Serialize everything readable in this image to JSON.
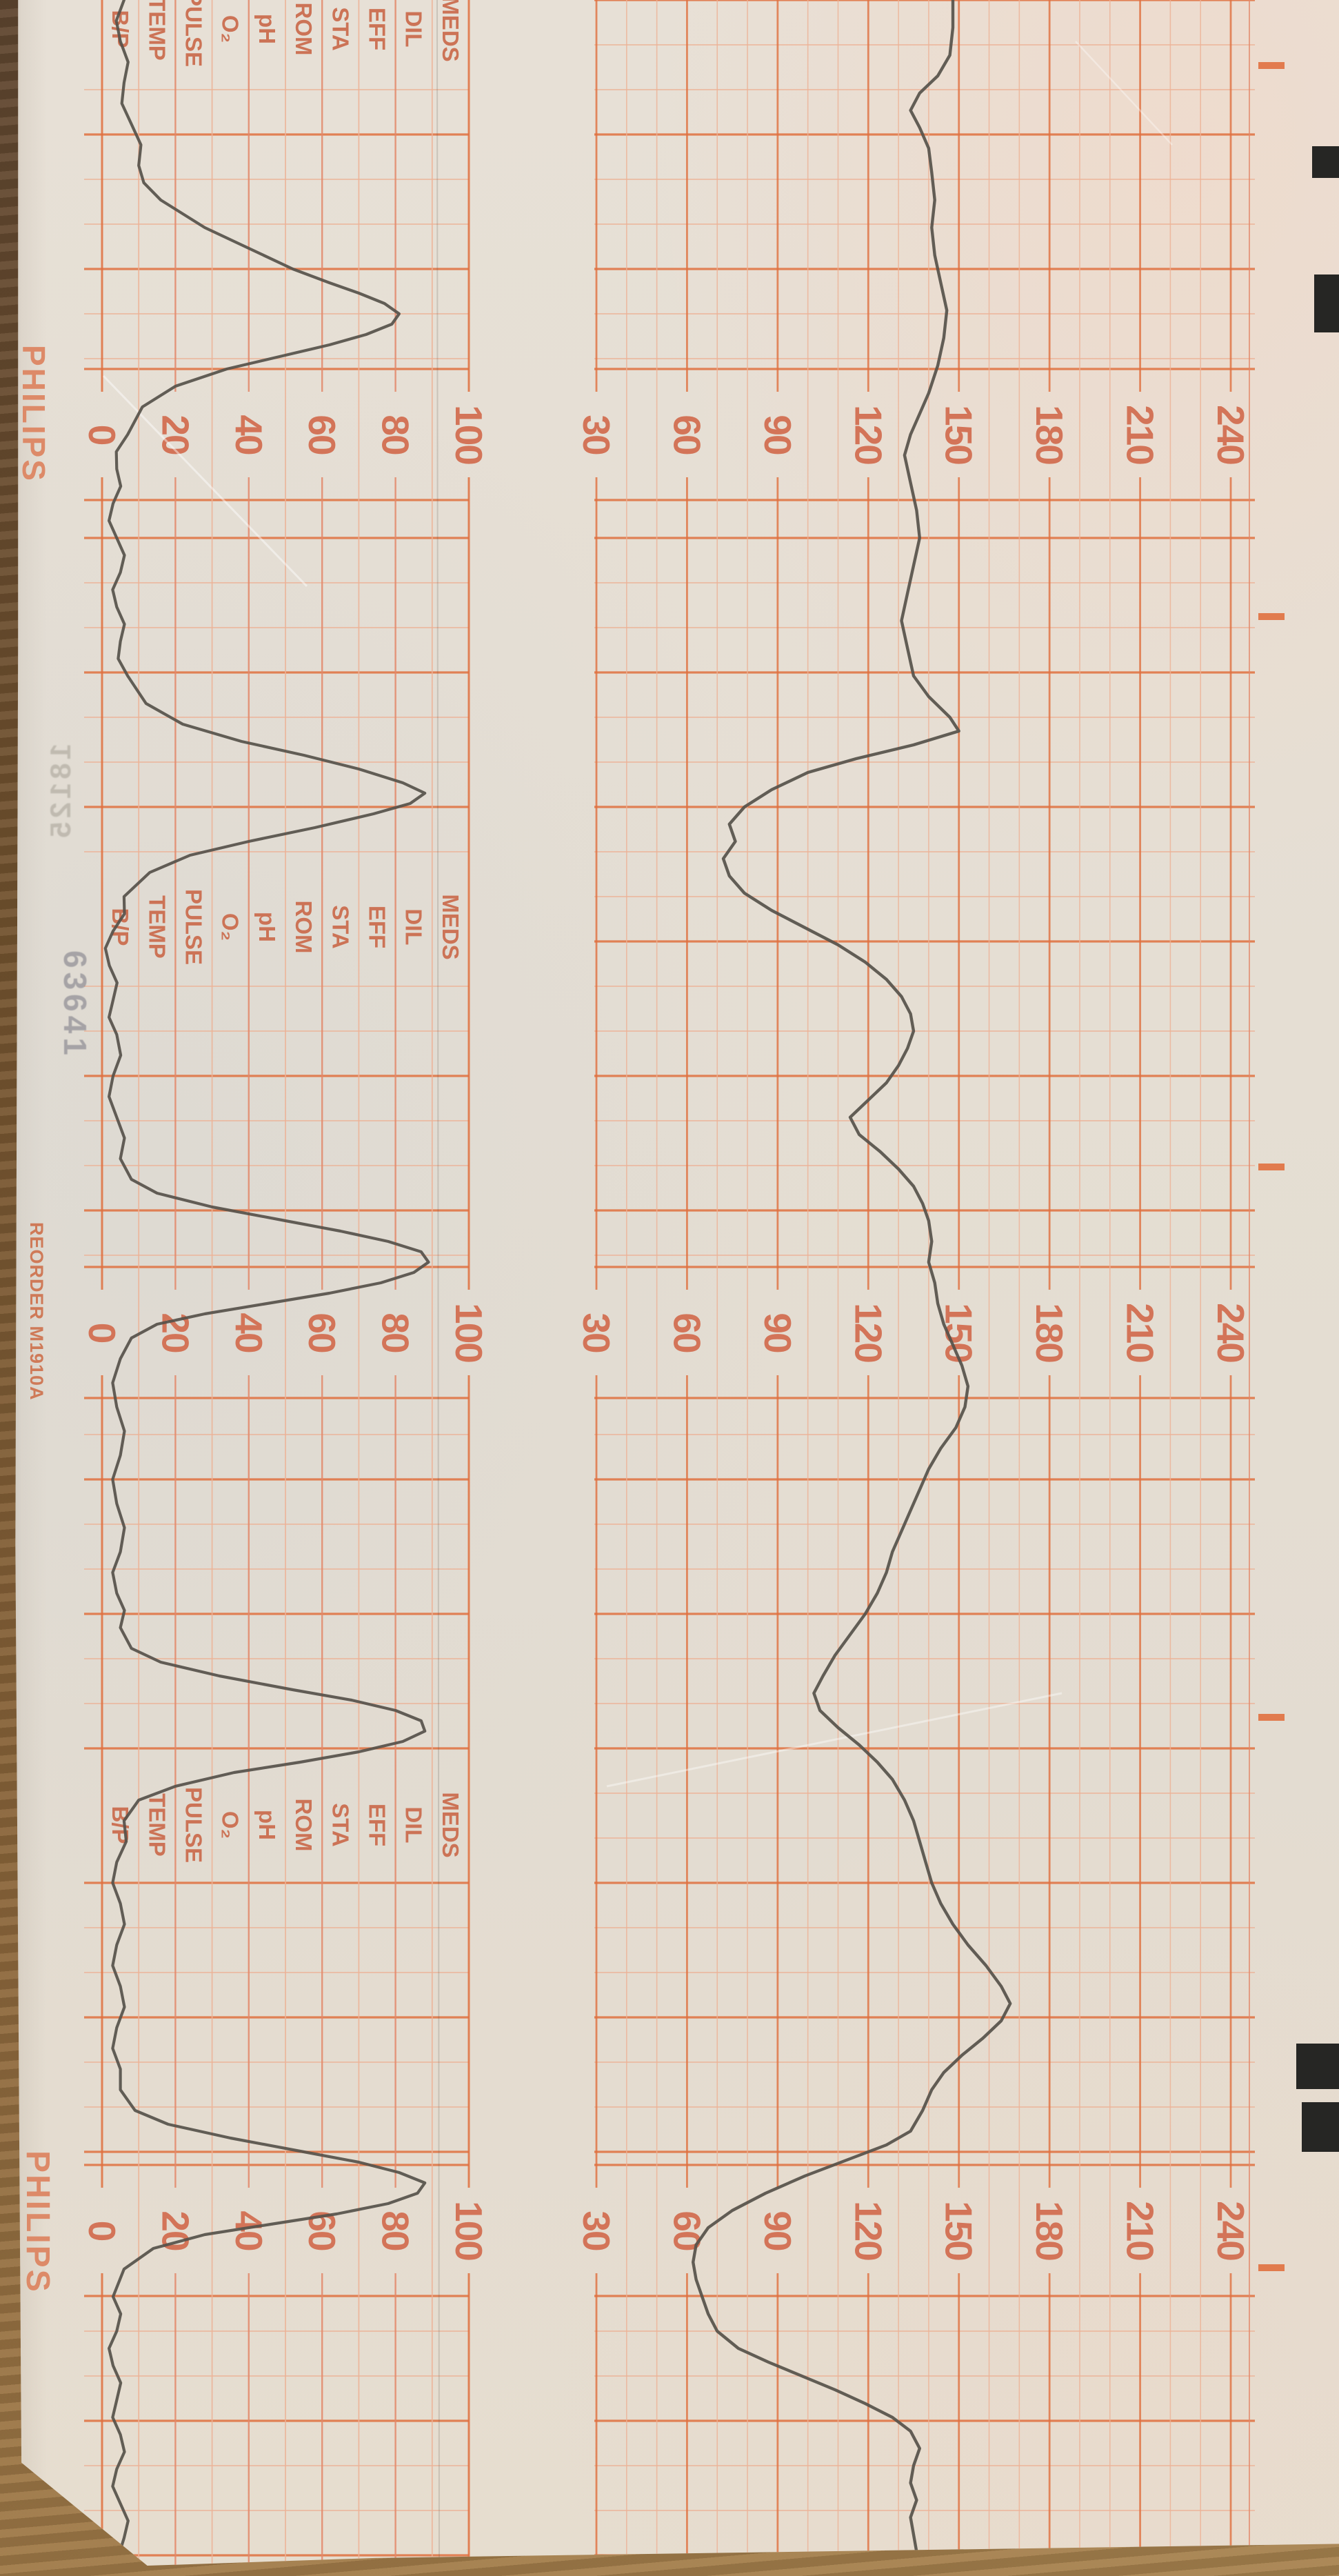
{
  "device": {
    "brand": "PHILIPS",
    "reorder_label": "REORDER M1910A",
    "stamp_number": "63641",
    "margin_ghost_number": "18125"
  },
  "scales": {
    "fhr": {
      "unit": "bpm",
      "min": 30,
      "max": 240,
      "major_step": 30,
      "minor_step": 10,
      "labels": [
        "30",
        "60",
        "90",
        "120",
        "150",
        "180",
        "210",
        "240"
      ]
    },
    "uterine": {
      "unit": "rel",
      "min": 0,
      "max": 100,
      "major_step": 20,
      "minor_step": 10,
      "labels": [
        "0",
        "20",
        "40",
        "60",
        "80",
        "100"
      ]
    }
  },
  "annotation_labels": [
    "MEDS",
    "DIL",
    "EFF",
    "STA",
    "ROM",
    "pH",
    "O₂",
    "PULSE",
    "TEMP",
    "B/P"
  ],
  "colors": {
    "grid_light": "#edb296",
    "grid_medium": "#e3886a",
    "grid_bold": "#e0703f",
    "scale_number": "#d26c4e",
    "annotation_label": "#cb6e50",
    "brand": "#dd8a68",
    "trace_ink": "#56514a",
    "black_mark": "#262624",
    "paper": "#e5ded3",
    "wood": "#7a5a35"
  },
  "chart_data": [
    {
      "type": "line",
      "name": "fetal_heart_rate",
      "legend": "FHR trace (pen)",
      "unit": "bpm",
      "axis_range": [
        30,
        240
      ],
      "x_axis": "image_y_px (time runs down the strip)",
      "points": [
        [
          0,
          148
        ],
        [
          40,
          148
        ],
        [
          80,
          147
        ],
        [
          110,
          143
        ],
        [
          135,
          137
        ],
        [
          160,
          134
        ],
        [
          185,
          137
        ],
        [
          215,
          140
        ],
        [
          250,
          141
        ],
        [
          290,
          142
        ],
        [
          330,
          141
        ],
        [
          370,
          142
        ],
        [
          410,
          144
        ],
        [
          450,
          146
        ],
        [
          490,
          145
        ],
        [
          530,
          143
        ],
        [
          570,
          140
        ],
        [
          600,
          137
        ],
        [
          630,
          134
        ],
        [
          660,
          132
        ],
        [
          700,
          134
        ],
        [
          740,
          136
        ],
        [
          780,
          137
        ],
        [
          820,
          135
        ],
        [
          860,
          133
        ],
        [
          900,
          131
        ],
        [
          940,
          133
        ],
        [
          980,
          135
        ],
        [
          1010,
          140
        ],
        [
          1040,
          147
        ],
        [
          1060,
          150
        ],
        [
          1080,
          135
        ],
        [
          1100,
          116
        ],
        [
          1120,
          100
        ],
        [
          1145,
          88
        ],
        [
          1170,
          79
        ],
        [
          1195,
          74
        ],
        [
          1220,
          76
        ],
        [
          1245,
          72
        ],
        [
          1270,
          74
        ],
        [
          1295,
          79
        ],
        [
          1320,
          88
        ],
        [
          1345,
          99
        ],
        [
          1370,
          110
        ],
        [
          1395,
          119
        ],
        [
          1420,
          126
        ],
        [
          1445,
          131
        ],
        [
          1470,
          134
        ],
        [
          1495,
          135
        ],
        [
          1520,
          133
        ],
        [
          1545,
          130
        ],
        [
          1570,
          126
        ],
        [
          1595,
          120
        ],
        [
          1620,
          114
        ],
        [
          1645,
          117
        ],
        [
          1670,
          124
        ],
        [
          1695,
          130
        ],
        [
          1720,
          135
        ],
        [
          1745,
          138
        ],
        [
          1770,
          140
        ],
        [
          1800,
          141
        ],
        [
          1830,
          140
        ],
        [
          1860,
          142
        ],
        [
          1890,
          143
        ],
        [
          1920,
          145
        ],
        [
          1950,
          148
        ],
        [
          1980,
          151
        ],
        [
          2010,
          153
        ],
        [
          2040,
          152
        ],
        [
          2070,
          149
        ],
        [
          2100,
          144
        ],
        [
          2130,
          140
        ],
        [
          2160,
          137
        ],
        [
          2190,
          134
        ],
        [
          2220,
          131
        ],
        [
          2250,
          128
        ],
        [
          2280,
          126
        ],
        [
          2310,
          123
        ],
        [
          2340,
          119
        ],
        [
          2370,
          114
        ],
        [
          2400,
          109
        ],
        [
          2430,
          105
        ],
        [
          2455,
          102
        ],
        [
          2480,
          104
        ],
        [
          2505,
          110
        ],
        [
          2530,
          117
        ],
        [
          2555,
          123
        ],
        [
          2580,
          128
        ],
        [
          2610,
          132
        ],
        [
          2640,
          135
        ],
        [
          2670,
          137
        ],
        [
          2700,
          139
        ],
        [
          2730,
          141
        ],
        [
          2760,
          144
        ],
        [
          2790,
          148
        ],
        [
          2820,
          153
        ],
        [
          2850,
          159
        ],
        [
          2880,
          164
        ],
        [
          2905,
          167
        ],
        [
          2930,
          164
        ],
        [
          2955,
          158
        ],
        [
          2980,
          151
        ],
        [
          3005,
          145
        ],
        [
          3030,
          141
        ],
        [
          3060,
          138
        ],
        [
          3090,
          134
        ],
        [
          3110,
          126
        ],
        [
          3130,
          114
        ],
        [
          3155,
          99
        ],
        [
          3180,
          86
        ],
        [
          3205,
          75
        ],
        [
          3230,
          67
        ],
        [
          3255,
          63
        ],
        [
          3280,
          62
        ],
        [
          3305,
          63
        ],
        [
          3330,
          65
        ],
        [
          3355,
          67
        ],
        [
          3380,
          70
        ],
        [
          3405,
          77
        ],
        [
          3425,
          87
        ],
        [
          3445,
          98
        ],
        [
          3465,
          109
        ],
        [
          3485,
          119
        ],
        [
          3505,
          128
        ],
        [
          3525,
          134
        ],
        [
          3550,
          137
        ],
        [
          3575,
          135
        ],
        [
          3600,
          134
        ],
        [
          3625,
          136
        ],
        [
          3650,
          134
        ],
        [
          3675,
          135
        ],
        [
          3700,
          136
        ],
        [
          3735,
          135
        ]
      ]
    },
    {
      "type": "line",
      "name": "uterine_activity",
      "legend": "Toco trace (pen)",
      "unit": "rel",
      "axis_range": [
        0,
        100
      ],
      "x_axis": "image_y_px (time runs down the strip)",
      "points": [
        [
          0,
          6
        ],
        [
          60,
          5
        ],
        [
          120,
          6
        ],
        [
          180,
          8
        ],
        [
          240,
          10
        ],
        [
          290,
          16
        ],
        [
          330,
          28
        ],
        [
          360,
          40
        ],
        [
          390,
          52
        ],
        [
          410,
          62
        ],
        [
          425,
          70
        ],
        [
          440,
          77
        ],
        [
          455,
          81
        ],
        [
          470,
          79
        ],
        [
          485,
          72
        ],
        [
          500,
          62
        ],
        [
          515,
          50
        ],
        [
          535,
          34
        ],
        [
          560,
          20
        ],
        [
          590,
          11
        ],
        [
          630,
          7
        ],
        [
          680,
          4
        ],
        [
          730,
          3
        ],
        [
          780,
          4
        ],
        [
          830,
          5
        ],
        [
          880,
          4
        ],
        [
          930,
          5
        ],
        [
          980,
          7
        ],
        [
          1020,
          12
        ],
        [
          1050,
          22
        ],
        [
          1075,
          38
        ],
        [
          1095,
          55
        ],
        [
          1115,
          70
        ],
        [
          1135,
          82
        ],
        [
          1150,
          88
        ],
        [
          1165,
          84
        ],
        [
          1180,
          74
        ],
        [
          1200,
          58
        ],
        [
          1220,
          40
        ],
        [
          1240,
          24
        ],
        [
          1265,
          13
        ],
        [
          1300,
          6
        ],
        [
          1350,
          3
        ],
        [
          1400,
          2
        ],
        [
          1450,
          3
        ],
        [
          1500,
          4
        ],
        [
          1560,
          3
        ],
        [
          1620,
          4
        ],
        [
          1680,
          5
        ],
        [
          1710,
          8
        ],
        [
          1730,
          15
        ],
        [
          1750,
          30
        ],
        [
          1770,
          50
        ],
        [
          1785,
          65
        ],
        [
          1800,
          78
        ],
        [
          1815,
          87
        ],
        [
          1830,
          89
        ],
        [
          1845,
          85
        ],
        [
          1860,
          76
        ],
        [
          1875,
          62
        ],
        [
          1890,
          45
        ],
        [
          1905,
          28
        ],
        [
          1920,
          15
        ],
        [
          1940,
          8
        ],
        [
          1970,
          5
        ],
        [
          2040,
          4
        ],
        [
          2110,
          5
        ],
        [
          2180,
          4
        ],
        [
          2250,
          5
        ],
        [
          2310,
          4
        ],
        [
          2360,
          5
        ],
        [
          2390,
          8
        ],
        [
          2410,
          16
        ],
        [
          2430,
          32
        ],
        [
          2450,
          52
        ],
        [
          2465,
          68
        ],
        [
          2480,
          80
        ],
        [
          2495,
          87
        ],
        [
          2510,
          88
        ],
        [
          2525,
          82
        ],
        [
          2540,
          70
        ],
        [
          2555,
          54
        ],
        [
          2570,
          36
        ],
        [
          2590,
          20
        ],
        [
          2610,
          10
        ],
        [
          2640,
          6
        ],
        [
          2700,
          4
        ],
        [
          2760,
          5
        ],
        [
          2820,
          4
        ],
        [
          2880,
          5
        ],
        [
          2940,
          4
        ],
        [
          3000,
          5
        ],
        [
          3030,
          5
        ],
        [
          3060,
          9
        ],
        [
          3080,
          18
        ],
        [
          3100,
          35
        ],
        [
          3120,
          55
        ],
        [
          3135,
          70
        ],
        [
          3150,
          81
        ],
        [
          3165,
          88
        ],
        [
          3180,
          86
        ],
        [
          3195,
          78
        ],
        [
          3210,
          64
        ],
        [
          3225,
          46
        ],
        [
          3240,
          28
        ],
        [
          3260,
          14
        ],
        [
          3290,
          6
        ],
        [
          3330,
          3
        ],
        [
          3380,
          4
        ],
        [
          3430,
          3
        ],
        [
          3480,
          4
        ],
        [
          3530,
          5
        ],
        [
          3580,
          4
        ],
        [
          3630,
          5
        ],
        [
          3680,
          6
        ],
        [
          3735,
          6
        ]
      ]
    }
  ]
}
